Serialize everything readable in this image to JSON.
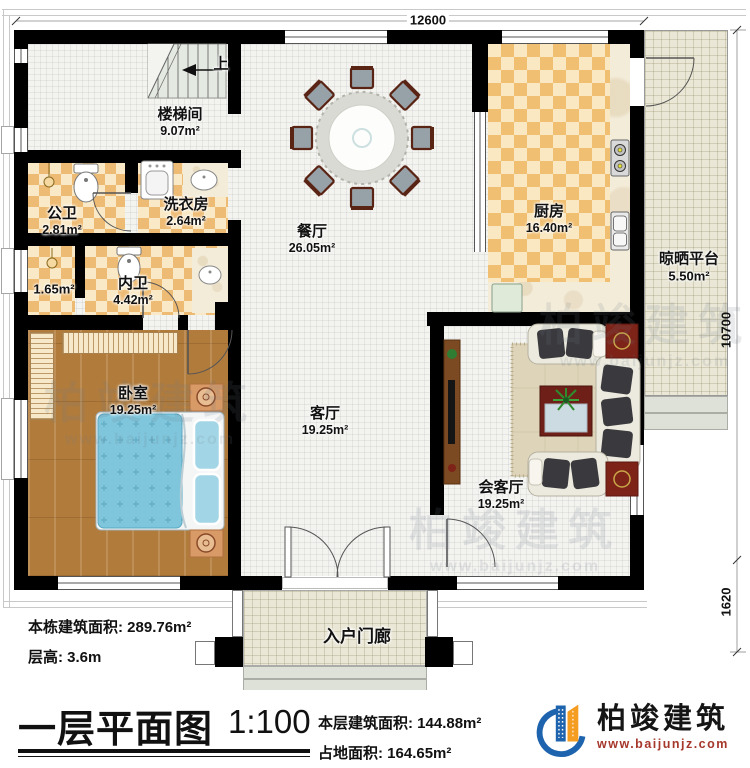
{
  "meta": {
    "title": "一层平面图",
    "scale": "1:100"
  },
  "stats": {
    "building_total_area": "本栋建筑面积: 289.76m²",
    "floor_height": "层高: 3.6m",
    "floor_area": "本层建筑面积: 144.88m²",
    "land_area": "占地面积: 164.65m²"
  },
  "dimensions": {
    "top": "12600",
    "right_main": "10700",
    "right_porch": "1620"
  },
  "rooms": {
    "stairwell": {
      "name": "楼梯间",
      "area": "9.07m²"
    },
    "public_bathroom": {
      "name": "公卫",
      "area": "2.81m²"
    },
    "laundry": {
      "name": "洗衣房",
      "area": "2.64m²"
    },
    "closet": {
      "area": "1.65m²"
    },
    "ensuite_bathroom": {
      "name": "内卫",
      "area": "4.42m²"
    },
    "dining_room": {
      "name": "餐厅",
      "area": "26.05m²"
    },
    "kitchen": {
      "name": "厨房",
      "area": "16.40m²"
    },
    "drying_platform": {
      "name": "晾晒平台",
      "area": "5.50m²"
    },
    "bedroom": {
      "name": "卧室",
      "area": "19.25m²"
    },
    "living_room": {
      "name": "客厅",
      "area": "19.25m²"
    },
    "reception_room": {
      "name": "会客厅",
      "area": "19.25m²"
    },
    "entry_porch": {
      "name": "入户门廊"
    }
  },
  "annotations": {
    "stairs_up": "上"
  },
  "brand": {
    "name": "柏竣建筑",
    "website": "www.baijunjz.com",
    "colors": {
      "blue": "#1e63ad",
      "orange": "#f59d20",
      "site_red": "#a6372b",
      "wall": "#000000"
    }
  },
  "watermark": {
    "name": "柏竣建筑",
    "website": "www.baijunjz.com"
  }
}
